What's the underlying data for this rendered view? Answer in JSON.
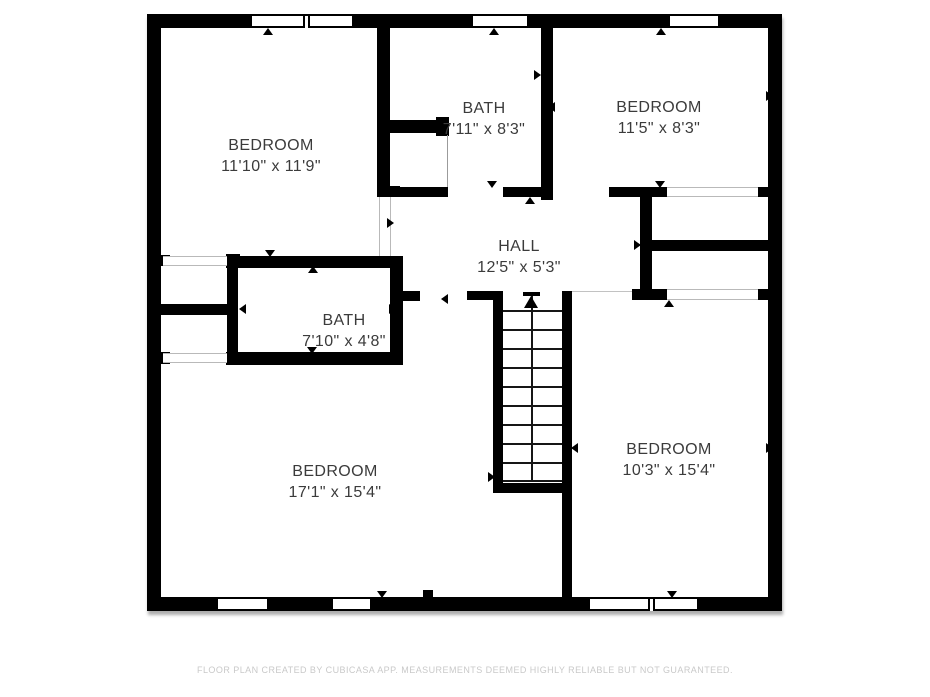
{
  "footer": {
    "text": "FLOOR PLAN CREATED BY CUBICASA APP. MEASUREMENTS DEEMED HIGHLY RELIABLE BUT NOT GUARANTEED."
  },
  "colors": {
    "wall": "#000000",
    "room_fill": "#ffffff",
    "label_text": "#3b3b3b",
    "footer_text": "#c9c9c9",
    "opening_line": "#b9b9b9"
  },
  "plan": {
    "outline": [
      147,
      14,
      635,
      597
    ]
  },
  "rooms": [
    {
      "id": "bedroom-top-left",
      "label": "BEDROOM",
      "dims": "11'10\" x 11'9\"",
      "x": 271,
      "y": 156
    },
    {
      "id": "bath-top",
      "label": "BATH",
      "dims": "7'11\" x 8'3\"",
      "x": 484,
      "y": 119
    },
    {
      "id": "bedroom-top-right",
      "label": "BEDROOM",
      "dims": "11'5\" x 8'3\"",
      "x": 659,
      "y": 118
    },
    {
      "id": "hall",
      "label": "HALL",
      "dims": "12'5\" x 5'3\"",
      "x": 519,
      "y": 257
    },
    {
      "id": "bath-middle",
      "label": "BATH",
      "dims": "7'10\" x 4'8\"",
      "x": 344,
      "y": 331
    },
    {
      "id": "bedroom-bottom-left",
      "label": "BEDROOM",
      "dims": "17'1\" x 15'4\"",
      "x": 335,
      "y": 482
    },
    {
      "id": "bedroom-bottom-right",
      "label": "BEDROOM",
      "dims": "10'3\" x 15'4\"",
      "x": 669,
      "y": 460
    }
  ],
  "geometry": {
    "walls": [
      {
        "name": "exterior-top-wall",
        "r": [
          147,
          14,
          635,
          14
        ]
      },
      {
        "name": "exterior-bottom-wall",
        "r": [
          147,
          597,
          635,
          14
        ]
      },
      {
        "name": "exterior-left-wall",
        "r": [
          147,
          14,
          14,
          597
        ]
      },
      {
        "name": "exterior-right-wall",
        "r": [
          768,
          14,
          14,
          597
        ]
      },
      {
        "name": "bath-top-left-wall",
        "r": [
          377,
          28,
          13,
          169
        ]
      },
      {
        "name": "bath-top-left-wall-cap",
        "r": [
          377,
          186,
          23,
          11
        ]
      },
      {
        "name": "bath-top-stub-wall",
        "r": [
          388,
          120,
          60,
          13
        ]
      },
      {
        "name": "bath-top-stub-cap",
        "r": [
          436,
          117,
          13,
          19
        ]
      },
      {
        "name": "bath-top-right-wall",
        "r": [
          541,
          28,
          12,
          172
        ]
      },
      {
        "name": "bath-top-bottom-wall-a",
        "r": [
          400,
          187,
          48,
          10
        ]
      },
      {
        "name": "bath-top-bottom-wall-b",
        "r": [
          503,
          187,
          38,
          10
        ]
      },
      {
        "name": "bedroom-tr-bottom-wall",
        "r": [
          609,
          187,
          58,
          10
        ]
      },
      {
        "name": "closet-right-vert-wall",
        "r": [
          640,
          187,
          12,
          112
        ]
      },
      {
        "name": "closet-right-mid-wall",
        "r": [
          652,
          240,
          116,
          11
        ]
      },
      {
        "name": "closet-right-stub-wall",
        "r": [
          632,
          289,
          35,
          11
        ]
      },
      {
        "name": "right-wall-notch-top",
        "r": [
          758,
          187,
          10,
          10
        ]
      },
      {
        "name": "right-wall-notch-bottom",
        "r": [
          758,
          289,
          10,
          11
        ]
      },
      {
        "name": "bath-mid-top-wall",
        "r": [
          226,
          256,
          172,
          12
        ]
      },
      {
        "name": "bath-mid-top-wall-cap",
        "r": [
          226,
          254,
          14,
          14
        ]
      },
      {
        "name": "closet-left-vert-wall",
        "r": [
          227,
          256,
          11,
          109
        ]
      },
      {
        "name": "closet-left-mid-wall",
        "r": [
          157,
          304,
          81,
          11
        ]
      },
      {
        "name": "left-wall-notch-top",
        "r": [
          161,
          255,
          9,
          11
        ]
      },
      {
        "name": "left-wall-notch-bottom",
        "r": [
          161,
          352,
          9,
          12
        ]
      },
      {
        "name": "bath-mid-right-wall",
        "r": [
          390,
          256,
          13,
          109
        ]
      },
      {
        "name": "hall-stub-wall",
        "r": [
          398,
          291,
          22,
          10
        ]
      },
      {
        "name": "bath-mid-bottom-wall",
        "r": [
          226,
          352,
          172,
          13
        ]
      },
      {
        "name": "stair-top-stub-wall",
        "r": [
          467,
          291,
          31,
          9
        ]
      },
      {
        "name": "stair-left-wall",
        "r": [
          493,
          291,
          10,
          202
        ]
      },
      {
        "name": "stair-right-wall",
        "r": [
          562,
          291,
          10,
          306
        ]
      },
      {
        "name": "stairwell-bottom-wall",
        "r": [
          493,
          483,
          79,
          10
        ]
      },
      {
        "name": "bottom-wall-stub",
        "r": [
          423,
          590,
          10,
          8
        ]
      }
    ],
    "windows": [
      {
        "name": "window-top-1",
        "edge": "top",
        "x": 247,
        "w": 110,
        "mullion": 51
      },
      {
        "name": "window-top-2",
        "edge": "top",
        "x": 468,
        "w": 64
      },
      {
        "name": "window-top-3",
        "edge": "top",
        "x": 665,
        "w": 58
      },
      {
        "name": "window-bottom-1",
        "edge": "bottom",
        "x": 213,
        "w": 59
      },
      {
        "name": "window-bottom-2",
        "edge": "bottom",
        "x": 328,
        "w": 47
      },
      {
        "name": "window-bottom-3",
        "edge": "bottom",
        "x": 585,
        "w": 117,
        "mullion": 58
      }
    ],
    "openings": [
      {
        "name": "closet-left-top-opening",
        "type": "h-lines",
        "r": [
          163,
          256,
          64,
          10
        ]
      },
      {
        "name": "closet-left-bottom-opening",
        "type": "h-lines",
        "r": [
          163,
          353,
          64,
          10
        ]
      },
      {
        "name": "closet-right-top-opening",
        "type": "h-lines",
        "r": [
          667,
          187,
          91,
          10
        ]
      },
      {
        "name": "closet-right-bottom-opening",
        "type": "h-lines",
        "r": [
          667,
          289,
          91,
          11
        ]
      },
      {
        "name": "bedroom-tl-doorway",
        "type": "v-lines",
        "r": [
          379,
          197,
          12,
          59
        ]
      },
      {
        "name": "bath-top-nook-line",
        "type": "line-v",
        "r": [
          447,
          135,
          1,
          52
        ]
      },
      {
        "name": "bedroom-br-doorway-line",
        "type": "line-h",
        "r": [
          572,
          291,
          60,
          1
        ]
      }
    ],
    "markers": [
      {
        "x": 268,
        "y": 31,
        "dir": "up"
      },
      {
        "x": 494,
        "y": 31,
        "dir": "up"
      },
      {
        "x": 661,
        "y": 31,
        "dir": "up"
      },
      {
        "x": 157,
        "y": 216,
        "dir": "left"
      },
      {
        "x": 390,
        "y": 223,
        "dir": "right"
      },
      {
        "x": 537,
        "y": 75,
        "dir": "right"
      },
      {
        "x": 551,
        "y": 107,
        "dir": "left"
      },
      {
        "x": 492,
        "y": 184,
        "dir": "down"
      },
      {
        "x": 530,
        "y": 200,
        "dir": "up"
      },
      {
        "x": 769,
        "y": 96,
        "dir": "right"
      },
      {
        "x": 660,
        "y": 184,
        "dir": "down"
      },
      {
        "x": 637,
        "y": 245,
        "dir": "right"
      },
      {
        "x": 669,
        "y": 303,
        "dir": "up"
      },
      {
        "x": 270,
        "y": 253,
        "dir": "down"
      },
      {
        "x": 313,
        "y": 269,
        "dir": "up"
      },
      {
        "x": 242,
        "y": 309,
        "dir": "left"
      },
      {
        "x": 392,
        "y": 309,
        "dir": "right"
      },
      {
        "x": 312,
        "y": 350,
        "dir": "down"
      },
      {
        "x": 444,
        "y": 299,
        "dir": "left"
      },
      {
        "x": 491,
        "y": 477,
        "dir": "right"
      },
      {
        "x": 574,
        "y": 448,
        "dir": "left"
      },
      {
        "x": 769,
        "y": 448,
        "dir": "right"
      },
      {
        "x": 156,
        "y": 478,
        "dir": "left"
      },
      {
        "x": 382,
        "y": 594,
        "dir": "down"
      },
      {
        "x": 672,
        "y": 594,
        "dir": "down"
      }
    ],
    "stairs": {
      "tread_x": 503,
      "tread_w": 59,
      "tread_ys": [
        310,
        329,
        348,
        367,
        386,
        405,
        424,
        443,
        462,
        480
      ],
      "centerline": {
        "x": 531,
        "y1": 296,
        "y2": 480
      },
      "tbar": [
        523,
        292,
        17,
        4
      ],
      "arrowhead": {
        "x": 531,
        "y": 296
      }
    }
  }
}
